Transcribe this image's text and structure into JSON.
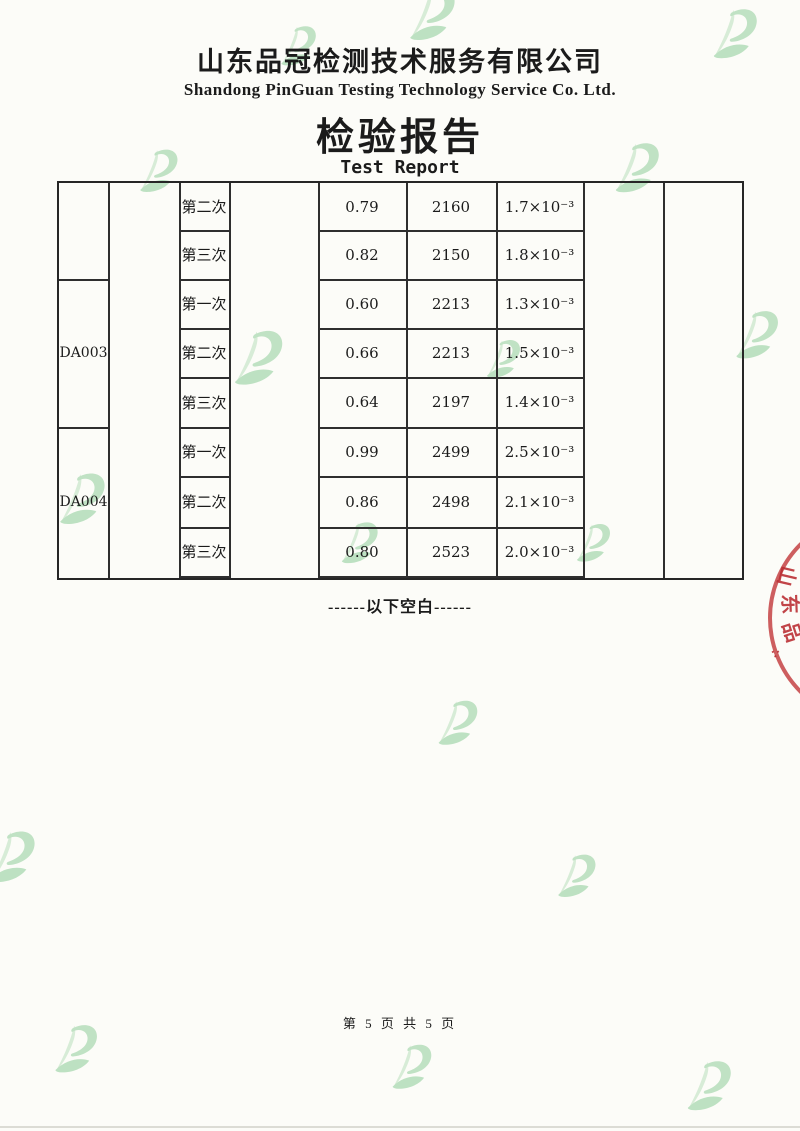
{
  "header": {
    "company_cn": "山东品冠检测技术服务有限公司",
    "company_en": "Shandong PinGuan Testing Technology Service Co. Ltd.",
    "report_title_cn": "检验报告",
    "report_title_en": "Test Report"
  },
  "table": {
    "sample_ids": {
      "block2": "DA003",
      "block3": "DA004"
    },
    "rows": [
      {
        "trial": "第二次",
        "v1": "0.79",
        "v2": "2160",
        "v3": "1.7×10⁻³"
      },
      {
        "trial": "第三次",
        "v1": "0.82",
        "v2": "2150",
        "v3": "1.8×10⁻³"
      },
      {
        "trial": "第一次",
        "v1": "0.60",
        "v2": "2213",
        "v3": "1.3×10⁻³"
      },
      {
        "trial": "第二次",
        "v1": "0.66",
        "v2": "2213",
        "v3": "1.5×10⁻³"
      },
      {
        "trial": "第三次",
        "v1": "0.64",
        "v2": "2197",
        "v3": "1.4×10⁻³"
      },
      {
        "trial": "第一次",
        "v1": "0.99",
        "v2": "2499",
        "v3": "2.5×10⁻³"
      },
      {
        "trial": "第二次",
        "v1": "0.86",
        "v2": "2498",
        "v3": "2.1×10⁻³"
      },
      {
        "trial": "第三次",
        "v1": "0.80",
        "v2": "2523",
        "v3": "2.0×10⁻³"
      }
    ]
  },
  "notes": {
    "end_of_data": "------以下空白------"
  },
  "footer": {
    "page_info": "第 5 页 共 5 页"
  },
  "stamp": {
    "partial_chars": [
      "山",
      "东",
      "品",
      "∴"
    ]
  },
  "colors": {
    "text": "#1b1b1b",
    "table_border": "#262626",
    "watermark_green_light": "#cfe9cf",
    "watermark_green": "#b2dcb8",
    "stamp_red": "#c23b3d",
    "paper": "#fcfcf8"
  }
}
